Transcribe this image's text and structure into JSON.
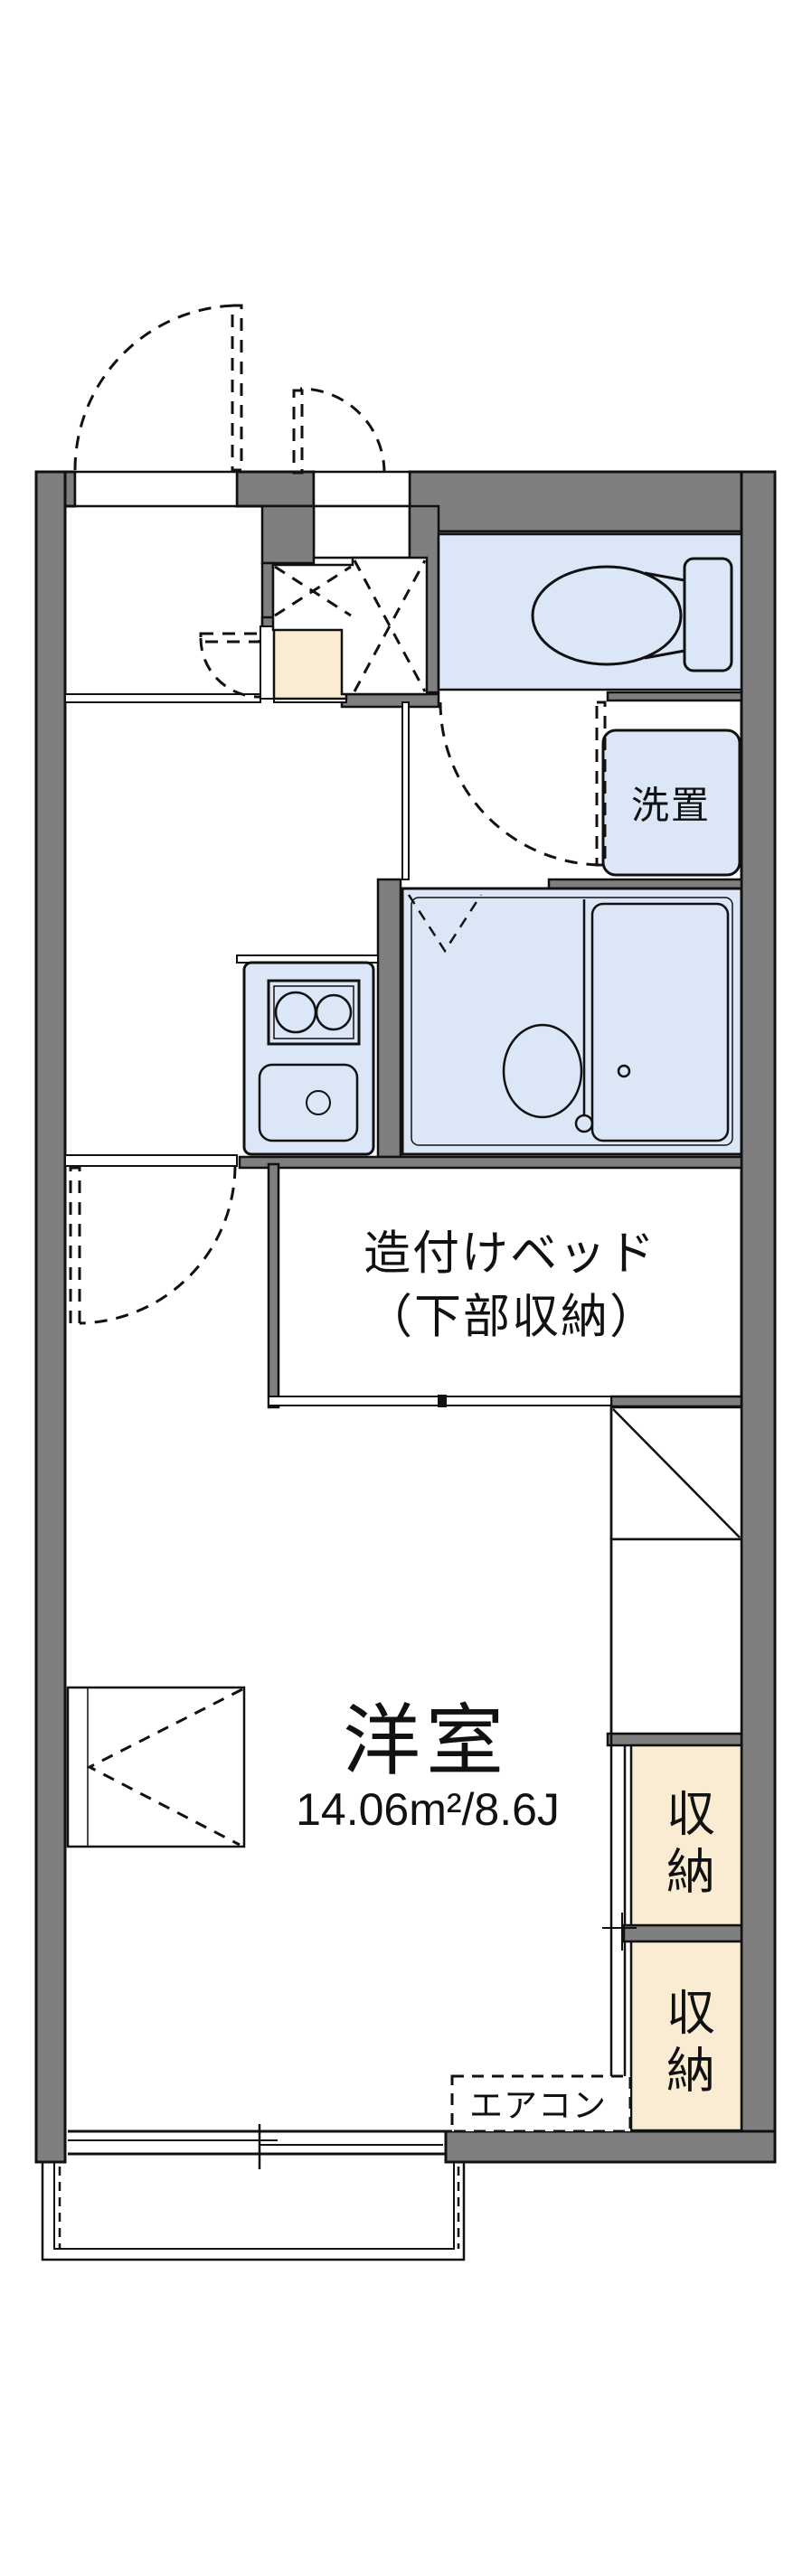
{
  "floorplan": {
    "title": "apartment-floor-plan",
    "labels": {
      "washer": "洗置",
      "bed_line1": "造付けベッド",
      "bed_line2": "（下部収納）",
      "room_name": "洋室",
      "room_size": "14.06m²/8.6J",
      "storage1": "収納",
      "storage2": "収納",
      "aircon": "エアコン"
    },
    "rooms": [
      {
        "name": "洋室",
        "area_sqm": "14.06",
        "area_tatami": "8.6J"
      },
      {
        "name": "造付けベッド（下部収納）"
      },
      {
        "name": "収納",
        "count": 2
      },
      {
        "name": "洗置"
      },
      {
        "name": "エアコン"
      }
    ],
    "colors": {
      "wall_gray": "#7f7f7f",
      "fixture_blue": "#dbe6f7",
      "storage_cream": "#faecd2",
      "line_black": "#111111",
      "background": "#ffffff"
    }
  }
}
